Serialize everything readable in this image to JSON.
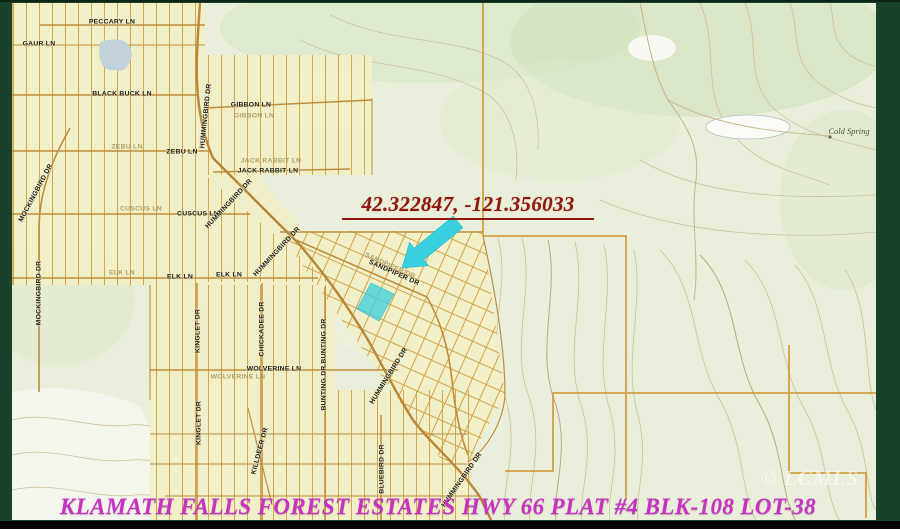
{
  "annotation": {
    "coordinates": "42.322847, -121.356033"
  },
  "caption": "KLAMATH FALLS FOREST ESTATES HWY 66 PLAT #4 BLK-108 LOT-38",
  "watermark": "© LCMLS",
  "colors": {
    "frame_green": "#17432b",
    "map_background": "#e9efda",
    "plat_yellow": "#f2efc7",
    "street_tan": "#d2a449",
    "section_orange": "#d29a3e",
    "contour_tan": "#c9bb92",
    "annotation_red": "#8f170d",
    "caption_magenta": "#c832c3",
    "highlight_cyan": "#3bd0e0"
  },
  "map": {
    "street_labels": [
      {
        "text": "PECCARY LN",
        "x": 112,
        "y": 22,
        "rot": 0,
        "cls": ""
      },
      {
        "text": "GAUR LN",
        "x": 39,
        "y": 44,
        "rot": 0,
        "cls": ""
      },
      {
        "text": "BLACK BUCK LN",
        "x": 122,
        "y": 94,
        "rot": 0,
        "cls": ""
      },
      {
        "text": "ZEBU LN",
        "x": 127,
        "y": 147,
        "rot": 0,
        "cls": "faded"
      },
      {
        "text": "ZEBU LN",
        "x": 182,
        "y": 152,
        "rot": 0,
        "cls": ""
      },
      {
        "text": "GIBBON LN",
        "x": 251,
        "y": 105,
        "rot": 0,
        "cls": ""
      },
      {
        "text": "GIBBON LN",
        "x": 254,
        "y": 116,
        "rot": 0,
        "cls": "faded"
      },
      {
        "text": "JACK RABBIT LN",
        "x": 271,
        "y": 161,
        "rot": 0,
        "cls": "faded"
      },
      {
        "text": "JACK RABBIT LN",
        "x": 268,
        "y": 171,
        "rot": 0,
        "cls": ""
      },
      {
        "text": "CUSCUS LN",
        "x": 141,
        "y": 209,
        "rot": 0,
        "cls": "faded"
      },
      {
        "text": "CUSCUS LN",
        "x": 198,
        "y": 214,
        "rot": 0,
        "cls": ""
      },
      {
        "text": "ELK LN",
        "x": 122,
        "y": 273,
        "rot": 0,
        "cls": "faded"
      },
      {
        "text": "ELK LN",
        "x": 180,
        "y": 277,
        "rot": 0,
        "cls": ""
      },
      {
        "text": "ELK LN",
        "x": 229,
        "y": 275,
        "rot": 0,
        "cls": ""
      },
      {
        "text": "WOLVERINE LN",
        "x": 274,
        "y": 369,
        "rot": 0,
        "cls": ""
      },
      {
        "text": "WOLVERINE LN",
        "x": 238,
        "y": 377,
        "rot": 0,
        "cls": "faded"
      },
      {
        "text": "MOCKINGBIRD DR",
        "x": 36,
        "y": 193,
        "rot": -62,
        "cls": ""
      },
      {
        "text": "MOCKINGBIRD DR",
        "x": 39,
        "y": 293,
        "rot": -90,
        "cls": ""
      },
      {
        "text": "HUMMINGBIRD DR",
        "x": 206,
        "y": 116,
        "rot": -84,
        "cls": ""
      },
      {
        "text": "HUMMINGBIRD DR",
        "x": 229,
        "y": 204,
        "rot": -47,
        "cls": ""
      },
      {
        "text": "HUMMINGBIRD DR",
        "x": 277,
        "y": 252,
        "rot": -47,
        "cls": ""
      },
      {
        "text": "HUMMINGBIRD DR",
        "x": 389,
        "y": 376,
        "rot": -58,
        "cls": ""
      },
      {
        "text": "HUMMINGBIRD DR",
        "x": 462,
        "y": 480,
        "rot": -55,
        "cls": ""
      },
      {
        "text": "SANDPIPER DR",
        "x": 390,
        "y": 266,
        "rot": 24,
        "cls": "faded"
      },
      {
        "text": "SANDPIPER DR",
        "x": 394,
        "y": 273,
        "rot": 24,
        "cls": ""
      },
      {
        "text": "KINGLET DR",
        "x": 198,
        "y": 331,
        "rot": -90,
        "cls": ""
      },
      {
        "text": "KINGLET DR",
        "x": 199,
        "y": 423,
        "rot": -90,
        "cls": ""
      },
      {
        "text": "CHICKADEE DR",
        "x": 262,
        "y": 329,
        "rot": -90,
        "cls": ""
      },
      {
        "text": "BUNTING DR",
        "x": 324,
        "y": 341,
        "rot": -90,
        "cls": ""
      },
      {
        "text": "BUNTING DR",
        "x": 324,
        "y": 388,
        "rot": -90,
        "cls": ""
      },
      {
        "text": "KILLDEER DR",
        "x": 260,
        "y": 451,
        "rot": -75,
        "cls": ""
      },
      {
        "text": "BLUEBIRD DR",
        "x": 382,
        "y": 469,
        "rot": -90,
        "cls": ""
      },
      {
        "text": "Cold Spring",
        "x": 849,
        "y": 131,
        "rot": 0,
        "cls": "topo-name"
      }
    ]
  }
}
